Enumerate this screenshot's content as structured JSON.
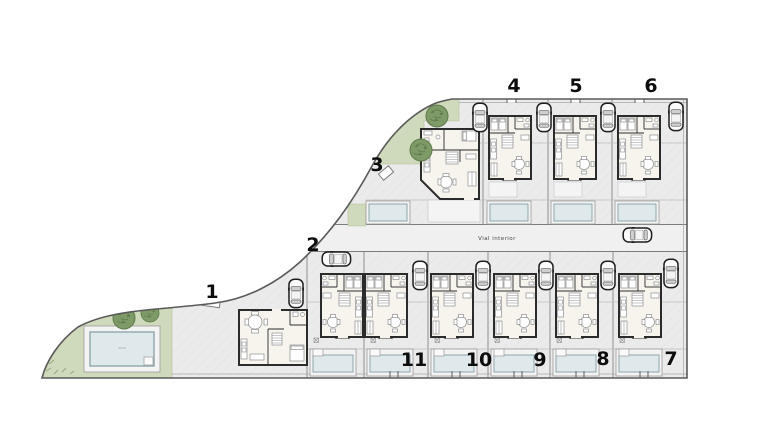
{
  "plan": {
    "road_label": "Vial interior",
    "units": [
      {
        "id": "unit-1",
        "label": "1"
      },
      {
        "id": "unit-2",
        "label": "2"
      },
      {
        "id": "unit-3",
        "label": "3"
      },
      {
        "id": "unit-4",
        "label": "4"
      },
      {
        "id": "unit-5",
        "label": "5"
      },
      {
        "id": "unit-6",
        "label": "6"
      },
      {
        "id": "unit-7",
        "label": "7"
      },
      {
        "id": "unit-8",
        "label": "8"
      },
      {
        "id": "unit-9",
        "label": "9"
      },
      {
        "id": "unit-10",
        "label": "10"
      },
      {
        "id": "unit-11",
        "label": "11"
      }
    ]
  },
  "colors": {
    "page-bg": "#ffffff",
    "ground": "#ebebeb",
    "ground-hatch": "#e1e1e1",
    "road": "#f0f0f0",
    "green": "#cfd9bb",
    "green-edge": "#b3c29a",
    "tree-dark": "#7e9a67",
    "tree-darker": "#5f7b4c",
    "tree-light": "#a4b88d",
    "water": "#dfe9ec",
    "water-edge": "#8fa6ad",
    "deck": "#f3f3f3",
    "wall": "#2b2b2b",
    "interior": "#f7f4ed",
    "furniture": "#8f8f8f",
    "boundary": "#5a5a5a",
    "division": "#8f8f8f",
    "label": "#0d0d0d",
    "car-body": "#fbfbfb",
    "car-outline": "#1d1d1d",
    "car-glass": "#cfcfcf"
  }
}
